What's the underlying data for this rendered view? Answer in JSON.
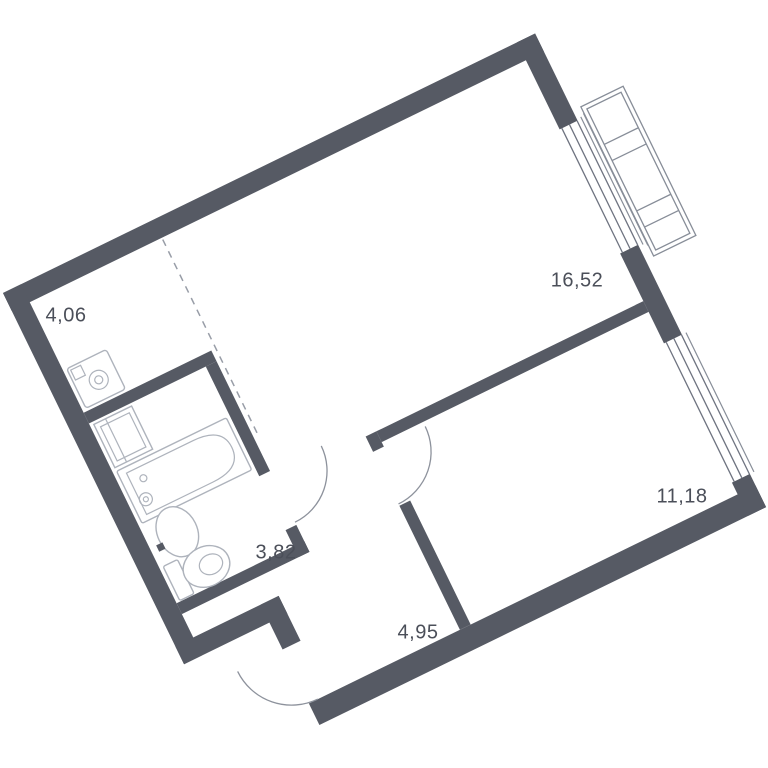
{
  "floor_plan": {
    "type": "apartment-floor-plan",
    "rotation_degrees": -26,
    "rooms": [
      {
        "name": "hallway",
        "area": "4,06"
      },
      {
        "name": "living-room",
        "area": "16,52"
      },
      {
        "name": "bedroom",
        "area": "11,18"
      },
      {
        "name": "bathroom",
        "area": "3,82"
      },
      {
        "name": "entry-corridor",
        "area": "4,95"
      }
    ],
    "fixtures": [
      "washing-machine",
      "bathroom-cabinet",
      "bathtub",
      "sink",
      "toilet",
      "balcony",
      "living-room-window",
      "bedroom-window",
      "entrance-door-arc",
      "bathroom-door-arc",
      "bedroom-door-arc",
      "zone-divider-dashed-line"
    ],
    "colors": {
      "wall": "#565a64",
      "window_line": "#6e7380",
      "balcony_line": "#878d98",
      "door_arc_line": "#8d929c",
      "fixture_line": "#aeb3bc",
      "dashed_line": "#989da7",
      "label_text": "#4b4f59",
      "background": "#ffffff"
    }
  }
}
